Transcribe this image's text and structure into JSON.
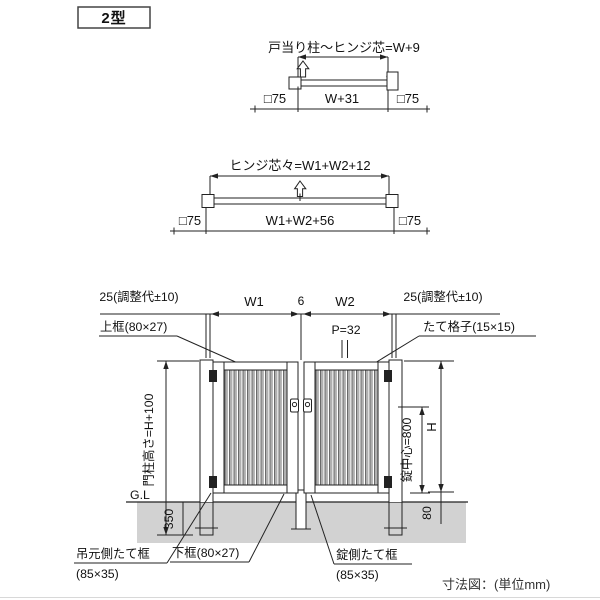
{
  "title_box": {
    "label": "2型"
  },
  "plan_single": {
    "hinge_dim": "戸当り柱～ヒンジ芯=W+9",
    "post_left": "□75",
    "width": "W+31",
    "post_right": "□75"
  },
  "plan_double": {
    "hinge_dim": "ヒンジ芯々=W1+W2+12",
    "post_left": "□75",
    "width": "W1+W2+56",
    "post_right": "□75"
  },
  "elevation": {
    "adjust_left": "25(調整代±10)",
    "w1": "W1",
    "center_gap": "6",
    "w2": "W2",
    "adjust_right": "25(調整代±10)",
    "top_rail": "上框(80×27)",
    "pitch": "P=32",
    "lattice": "たて格子(15×15)",
    "post_height": "門柱高さ=H+100",
    "ground_line": "G.L",
    "embed_depth": "350",
    "lock_center": "錠中心=800",
    "height": "H",
    "ground_clearance": "80",
    "hinge_stile": "吊元側たて框",
    "hinge_stile_size": "(85×35)",
    "bottom_rail": "下框(80×27)",
    "lock_stile": "錠側たて框",
    "lock_stile_size": "(85×35)"
  },
  "footer": {
    "note": "寸法図：(単位mm)"
  },
  "colors": {
    "line": "#222222",
    "text": "#111111",
    "ground": "#d2d2d2",
    "lattice": "#b0b0b0"
  }
}
